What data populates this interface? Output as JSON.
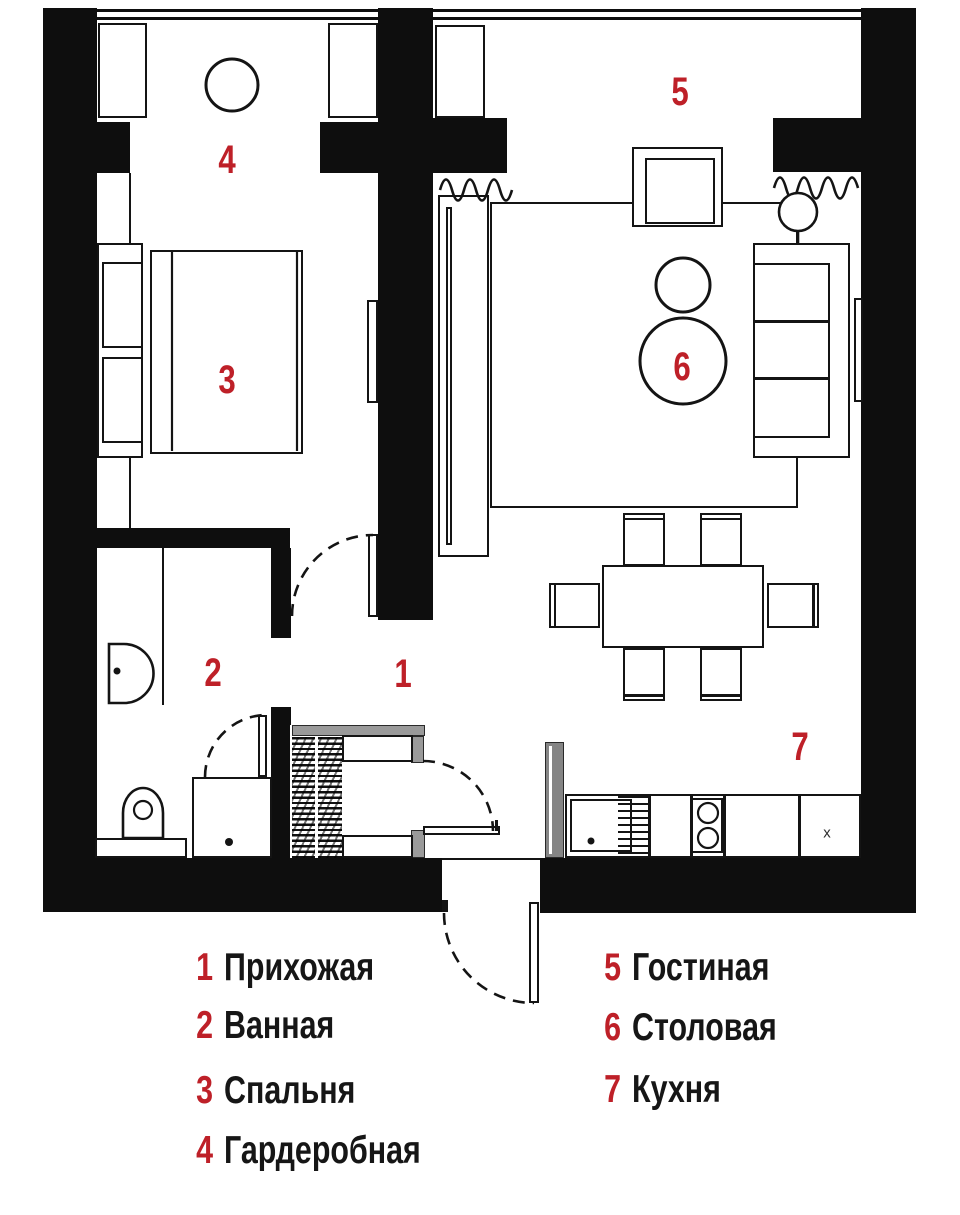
{
  "colors": {
    "accent_red": "#be2028",
    "line_black": "#141414",
    "gray_light": "#9a9a9a",
    "gray_mid": "#8f8f8f"
  },
  "rooms": [
    {
      "num": "1",
      "name": "Прихожая"
    },
    {
      "num": "2",
      "name": "Ванная"
    },
    {
      "num": "3",
      "name": "Спальня"
    },
    {
      "num": "4",
      "name": "Гардеробная"
    },
    {
      "num": "5",
      "name": "Гостиная"
    },
    {
      "num": "6",
      "name": "Столовая"
    },
    {
      "num": "7",
      "name": "Кухня"
    }
  ],
  "kitchen": {
    "cabinet_mark": "x"
  }
}
